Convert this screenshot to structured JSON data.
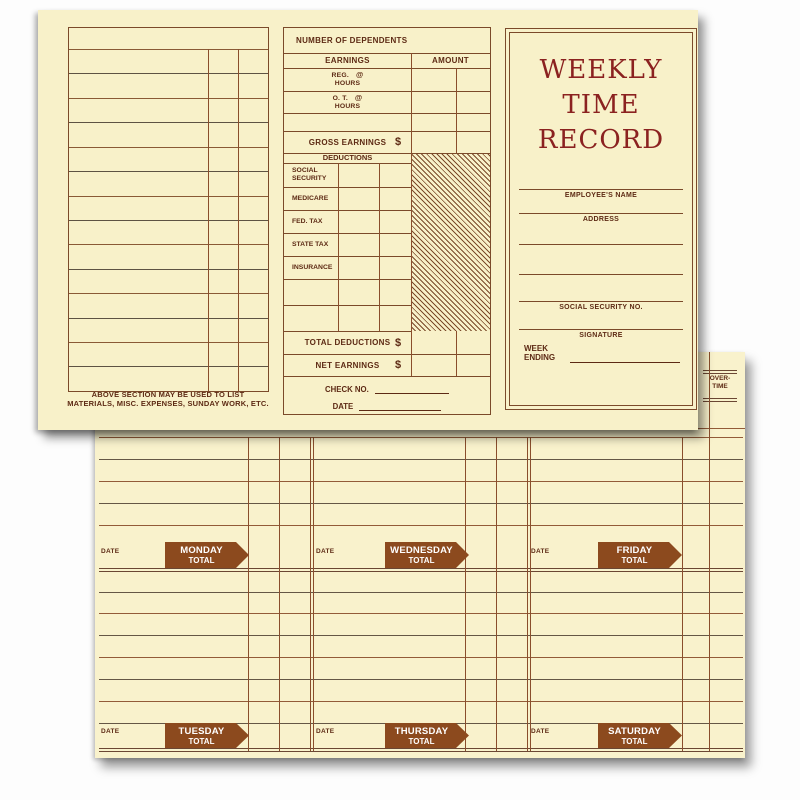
{
  "colors": {
    "paper": "#f8f1c9",
    "line_brown": "#8a4e2c",
    "line_dark": "#655745",
    "text_brown": "#5d2a14",
    "title_maroon": "#8b2220",
    "banner_brown": "#8c4a1e",
    "banner_text": "#ffffff"
  },
  "top_card": {
    "left_panel": {
      "note_line1": "ABOVE SECTION MAY BE USED TO LIST",
      "note_line2": "MATERIALS, MISC. EXPENSES, SUNDAY WORK, ETC."
    },
    "middle_panel": {
      "dependents_label": "NUMBER OF DEPENDENTS",
      "earnings_label": "EARNINGS",
      "amount_label": "AMOUNT",
      "reg_label": "REG.",
      "ot_label": "O. T.",
      "hours_label": "HOURS",
      "at_sign": "@",
      "gross_label": "GROSS EARNINGS",
      "dollar_sign": "$",
      "deductions_label": "DEDUCTIONS",
      "deductions": [
        "SOCIAL SECURITY",
        "MEDICARE",
        "FED. TAX",
        "STATE TAX",
        "INSURANCE"
      ],
      "total_deductions_label": "TOTAL DEDUCTIONS",
      "net_earnings_label": "NET EARNINGS",
      "check_no_label": "CHECK NO.",
      "date_label": "DATE"
    },
    "right_panel": {
      "title_line1": "WEEKLY",
      "title_line2": "TIME",
      "title_line3": "RECORD",
      "employee_name_label": "EMPLOYEE'S NAME",
      "address_label": "ADDRESS",
      "ssn_label": "SOCIAL SECURITY NO.",
      "signature_label": "SIGNATURE",
      "week_label": "WEEK",
      "ending_label": "ENDING"
    }
  },
  "bottom_card": {
    "overtime_line1": "OVER-",
    "overtime_line2": "TIME",
    "date_label": "DATE",
    "total_label": "TOTAL",
    "day_banners_row1": [
      "MONDAY",
      "WEDNESDAY",
      "FRIDAY"
    ],
    "day_banners_row2": [
      "TUESDAY",
      "THURSDAY",
      "SATURDAY"
    ]
  }
}
